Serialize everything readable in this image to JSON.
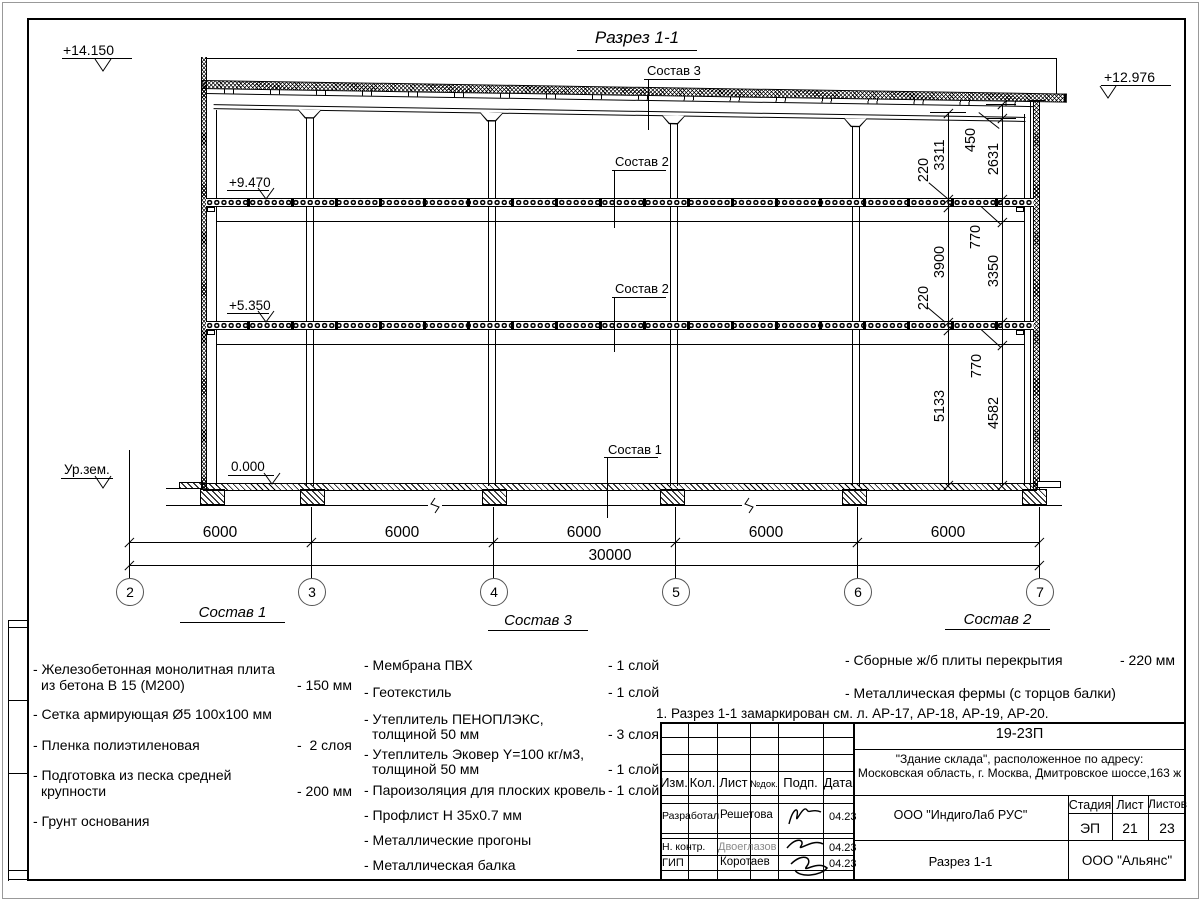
{
  "sheet": {
    "title": "Разрез 1-1"
  },
  "levels": {
    "l14": "+14.150",
    "l12": "+12.976",
    "l9": "+9.470",
    "l5": "+5.350",
    "l0": "0.000",
    "ground": "Ур.зем."
  },
  "callouts": {
    "c1": "Состав 1",
    "c2": "Состав 2",
    "c3": "Состав 3"
  },
  "axes": [
    "2",
    "3",
    "4",
    "5",
    "6",
    "7"
  ],
  "dims": {
    "bays": [
      "6000",
      "6000",
      "6000",
      "6000",
      "6000"
    ],
    "total": "30000",
    "chain1": [
      "3311",
      "220",
      "3900",
      "220",
      "5133"
    ],
    "chain2": [
      "450",
      "2631",
      "770",
      "3350",
      "770",
      "4582"
    ]
  },
  "compositions": [
    {
      "heading": "Состав 1",
      "items": [
        {
          "l1": "- Железобетонная  монолитная плита",
          "l2": "из бетона В 15 (М200)",
          "val": "- 150 мм"
        },
        {
          "l1": "- Сетка армирующая Ø5 100х100 мм"
        },
        {
          "l1": "- Пленка полиэтиленовая",
          "val": "-  2 слоя"
        },
        {
          "l1": "- Подготовка из песка средней",
          "l2": "крупности",
          "val": "- 200 мм"
        },
        {
          "l1": "- Грунт основания"
        }
      ]
    },
    {
      "heading": "Состав 3",
      "items": [
        {
          "l1": "- Мембрана ПВХ",
          "val": "- 1 слой"
        },
        {
          "l1": "- Геотекстиль",
          "val": "- 1 слой"
        },
        {
          "l1": "- Утеплитель ПЕНОПЛЭКС,",
          "l2": "толщиной 50 мм",
          "val": "- 3 слоя"
        },
        {
          "l1": "- Утеплитель Эковер Y=100 кг/м3,",
          "l2": "толщиной 50 мм",
          "val": "- 1 слой"
        },
        {
          "l1": "- Пароизоляция для плоских кровель",
          "val": "- 1 слой"
        },
        {
          "l1": "- Профлист Н 35х0.7 мм"
        },
        {
          "l1": "- Металлические прогоны"
        },
        {
          "l1": "- Металлическая балка"
        }
      ]
    },
    {
      "heading": "Состав 2",
      "items": [
        {
          "l1": "- Сборные ж/б плиты перекрытия",
          "val": "- 220 мм"
        },
        {
          "l1": "- Металлическая фермы (с торцов балки)"
        }
      ]
    }
  ],
  "note": "1. Разрез 1-1 замаркирован см. л. АР-17, АР-18, АР-19, АР-20.",
  "titleblock": {
    "code": "19-23П",
    "object_line1": "\"Здание склада\", расположенное по адресу:",
    "object_line2": "Московская область, г. Москва, Дмитровское шоссе,163 ж",
    "cols": [
      "Изм.",
      "Кол.",
      "Лист",
      "№док.",
      "Подп.",
      "Дата"
    ],
    "rows": [
      {
        "role": "Разработал",
        "name": "Решетова",
        "date": "04.23"
      },
      {
        "role": "Н. контр.",
        "name": "Двоеглазов",
        "date": "04.23"
      },
      {
        "role": "ГИП",
        "name": "Коротаев",
        "date": "04.23"
      }
    ],
    "designer_org": "ООО \"ИндигоЛаб РУС\"",
    "stage_cols": [
      "Стадия",
      "Лист",
      "Листов"
    ],
    "stage": "ЭП",
    "sheet": "21",
    "sheets": "23",
    "drawing_name": "Разрез 1-1",
    "company": "ООО \"Альянс\""
  }
}
